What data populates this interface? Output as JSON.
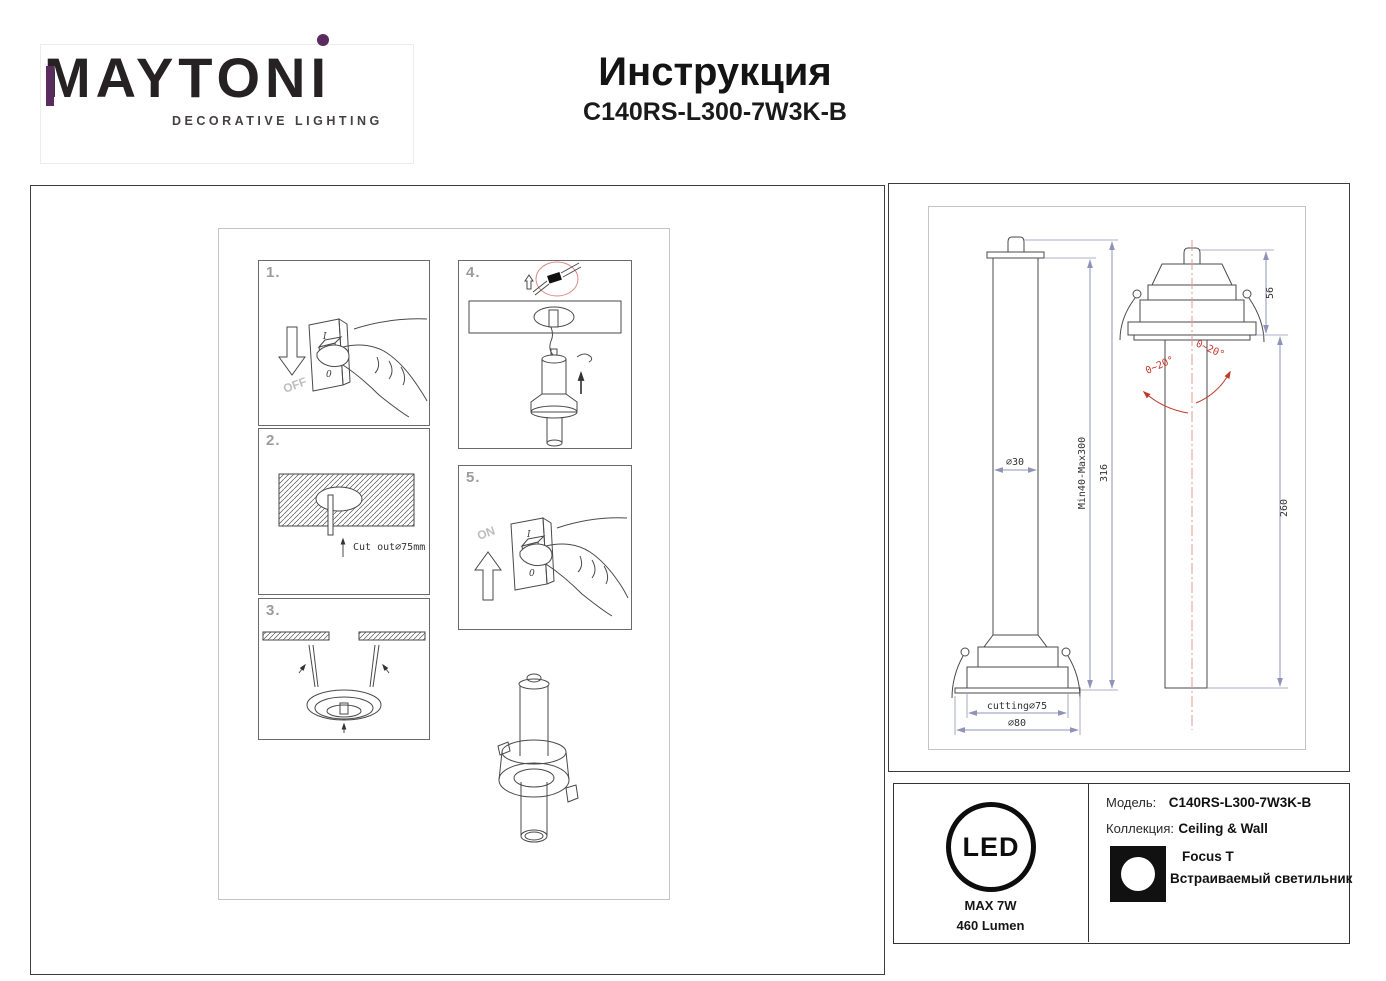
{
  "header": {
    "brand_prefix": "MAYTON",
    "brand_last_letter": "I",
    "tagline": "DECORATIVE LIGHTING",
    "title": "Инструкция",
    "model": "C140RS-L300-7W3K-B"
  },
  "steps": {
    "s1": {
      "label": "1.",
      "arrow_text": "OFF",
      "switch_on": "I",
      "switch_off": "0"
    },
    "s2": {
      "label": "2.",
      "cutout_text": "Cut out∅75mm"
    },
    "s3": {
      "label": "3."
    },
    "s4": {
      "label": "4."
    },
    "s5": {
      "label": "5.",
      "arrow_text": "ON",
      "switch_on": "I",
      "switch_off": "0"
    }
  },
  "drawing": {
    "front": {
      "tube_diameter": "∅30",
      "adjustable_height": "Min40-Max300",
      "total_height": "316",
      "cutout": "cutting∅75",
      "flange_diameter": "∅80"
    },
    "side": {
      "recess_depth": "56",
      "tube_length": "260",
      "tilt_left": "0~20°",
      "tilt_right": "0~20°"
    }
  },
  "footer": {
    "led_text": "LED",
    "max_power": "MAX 7W",
    "lumen": "460 Lumen",
    "model_label": "Модель:",
    "model_value": "C140RS-L300-7W3K-B",
    "collection_label": "Коллекция:",
    "collection_value": "Ceiling & Wall",
    "series": "Focus T",
    "product_type": "Встраиваемый светильник"
  },
  "colors": {
    "accent_purple": "#5b2a5e",
    "dimension_line": "#9093b8",
    "annotation_red": "#c0392b",
    "centerline_red": "#e59a92"
  }
}
